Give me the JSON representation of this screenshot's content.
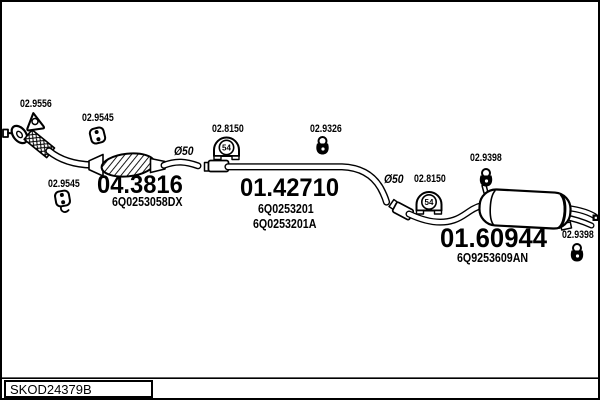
{
  "footer": {
    "drawing_code": "SKOD24379B"
  },
  "parts": {
    "front_gasket": {
      "ref": "02.9556"
    },
    "mount_front_upper": {
      "ref": "02.9545"
    },
    "mount_front_lower": {
      "ref": "02.9545"
    },
    "catalyst": {
      "article": "04.3816",
      "oem": "6Q0253058DX"
    },
    "pipe_diameter_front": "Ø50",
    "clamp_front": {
      "ref": "02.8150",
      "size": "54"
    },
    "hanger_centre": {
      "ref": "02.9326"
    },
    "centre_pipe": {
      "article": "01.42710",
      "oem_a": "6Q0253201",
      "oem_b": "6Q0253201A"
    },
    "pipe_diameter_rear": "Ø50",
    "clamp_rear": {
      "ref": "02.8150",
      "size": "54"
    },
    "hanger_rear_front": {
      "ref": "02.9398"
    },
    "rear_silencer": {
      "article": "01.60944",
      "oem": "6Q9253609AN"
    },
    "hanger_rear_end": {
      "ref": "02.9398"
    }
  }
}
